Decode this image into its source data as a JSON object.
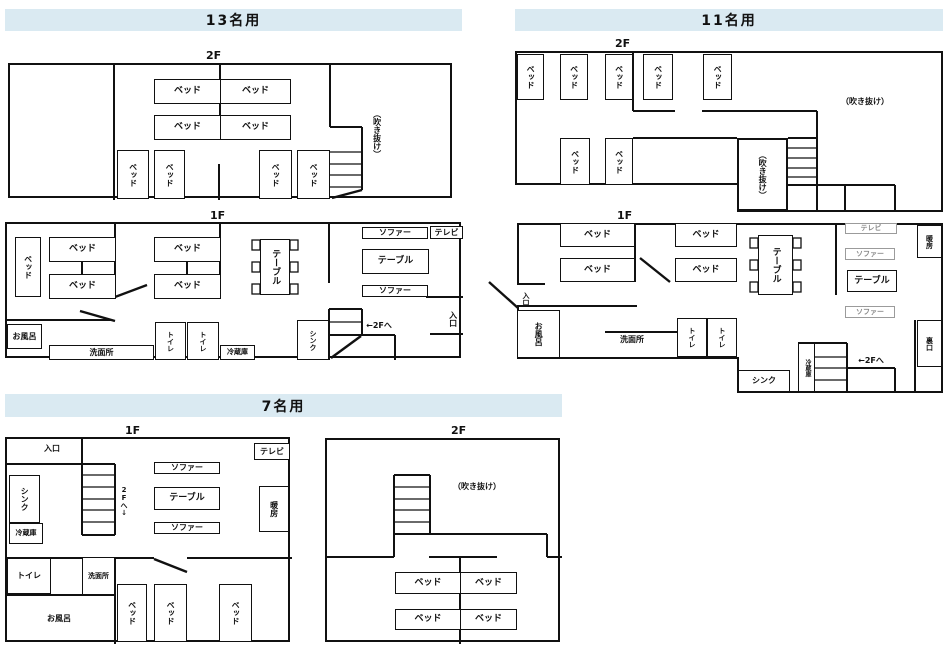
{
  "sections": {
    "s13": "13名用",
    "s11": "11名用",
    "s7": "7名用"
  },
  "labels": {
    "f1": "1F",
    "f2": "2F",
    "bed": "ベッド",
    "sofa": "ソファー",
    "table": "テーブル",
    "tv": "テレビ",
    "toilet": "トイレ",
    "fridge": "冷蔵庫",
    "sink": "シンク",
    "bath": "お風呂",
    "washroom": "洗面所",
    "entrance": "入口",
    "back_exit": "裏口",
    "heater": "暖房",
    "atrium": "（吹き抜け）",
    "to_2f": "←2Fへ",
    "to_2f_down": "2Fへ↓"
  },
  "colors": {
    "header_bg": "#daeaf2",
    "line": "#111111",
    "muted": "#8a8a8a"
  }
}
